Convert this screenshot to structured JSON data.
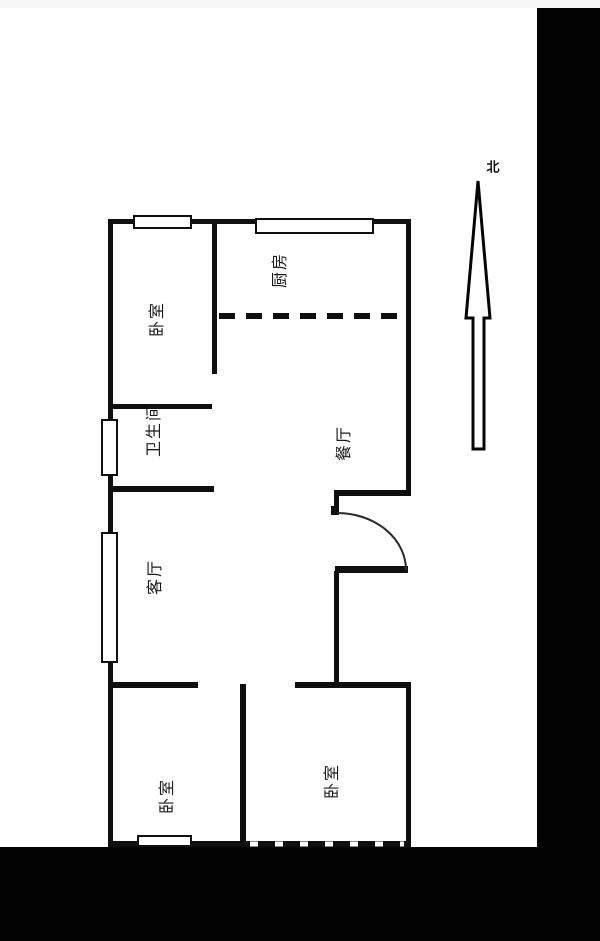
{
  "title": "apartment-floor-plan",
  "colors": {
    "wall": "#0f0f0f",
    "background": "#ffffff",
    "masking_band": "#030303"
  },
  "compass": {
    "label": "北",
    "direction": "north"
  },
  "rooms": [
    {
      "id": "bedroom-top-left",
      "label": "卧室"
    },
    {
      "id": "kitchen",
      "label": "厨房"
    },
    {
      "id": "bathroom",
      "label": "卫生间"
    },
    {
      "id": "dining-room",
      "label": "餐厅"
    },
    {
      "id": "living-room",
      "label": "客厅"
    },
    {
      "id": "bedroom-bottom-left",
      "label": "卧室"
    },
    {
      "id": "bedroom-bottom-right",
      "label": "卧室"
    }
  ]
}
